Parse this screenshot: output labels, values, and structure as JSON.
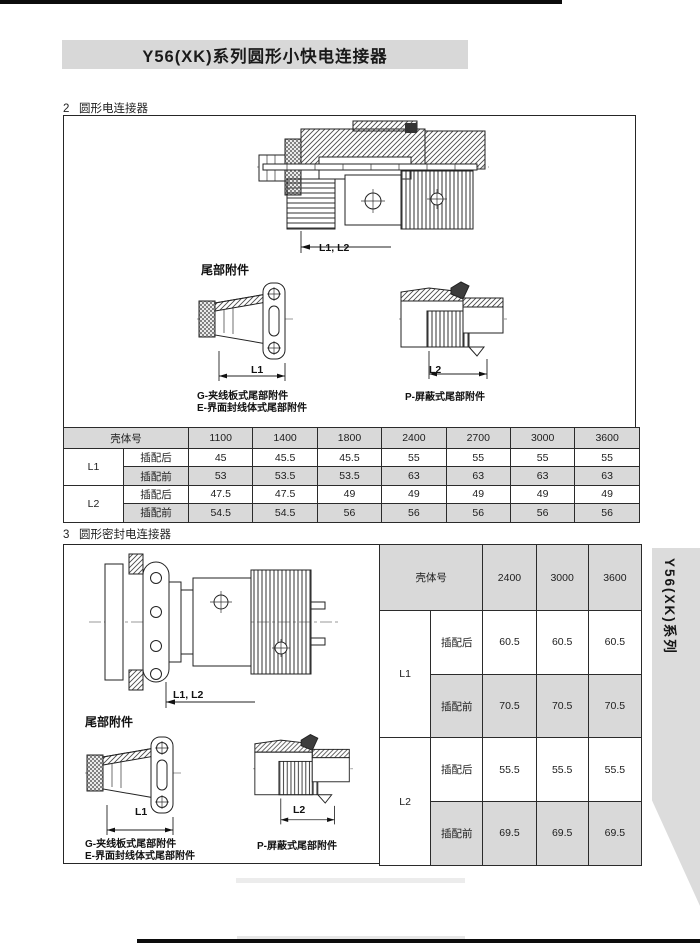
{
  "title_bar": {
    "text": "Y56(XK)系列圆形小快电连接器"
  },
  "side_tab": {
    "text": "Y56(XK)系列"
  },
  "colors": {
    "panel_gray": "#d8d8d8",
    "table_gray": "#d9d9d9",
    "tab_gray": "#dcdcdc",
    "line": "#262626"
  },
  "section2": {
    "heading": "2   圆形电连接器",
    "labels": {
      "dim_l1l2": "L1, L2",
      "tail_title": "尾部附件",
      "dim_l1": "L1",
      "dim_l2": "L2",
      "caption_g": "G-夹线板式尾部附件",
      "caption_e": "E-界面封线体式尾部附件",
      "caption_p": "P-屏蔽式尾部附件"
    },
    "table": {
      "header_label": "壳体号",
      "columns": [
        "1100",
        "1400",
        "1800",
        "2400",
        "2700",
        "3000",
        "3600"
      ],
      "groups": [
        {
          "name": "L1",
          "rows": [
            {
              "label": "插配后",
              "values": [
                "45",
                "45.5",
                "45.5",
                "55",
                "55",
                "55",
                "55"
              ]
            },
            {
              "label": "插配前",
              "values": [
                "53",
                "53.5",
                "53.5",
                "63",
                "63",
                "63",
                "63"
              ]
            }
          ]
        },
        {
          "name": "L2",
          "rows": [
            {
              "label": "插配后",
              "values": [
                "47.5",
                "47.5",
                "49",
                "49",
                "49",
                "49",
                "49"
              ]
            },
            {
              "label": "插配前",
              "values": [
                "54.5",
                "54.5",
                "56",
                "56",
                "56",
                "56",
                "56"
              ]
            }
          ]
        }
      ]
    }
  },
  "section3": {
    "heading": "3   圆形密封电连接器",
    "labels": {
      "dim_l1l2": "L1, L2",
      "tail_title": "尾部附件",
      "dim_l1": "L1",
      "dim_l2": "L2",
      "caption_g": "G-夹线板式尾部附件",
      "caption_e": "E-界面封线体式尾部附件",
      "caption_p": "P-屏蔽式尾部附件"
    },
    "table": {
      "header_label": "壳体号",
      "columns": [
        "2400",
        "3000",
        "3600"
      ],
      "groups": [
        {
          "name": "L1",
          "rows": [
            {
              "label": "插配后",
              "values": [
                "60.5",
                "60.5",
                "60.5"
              ]
            },
            {
              "label": "插配前",
              "values": [
                "70.5",
                "70.5",
                "70.5"
              ]
            }
          ]
        },
        {
          "name": "L2",
          "rows": [
            {
              "label": "插配后",
              "values": [
                "55.5",
                "55.5",
                "55.5"
              ]
            },
            {
              "label": "插配前",
              "values": [
                "69.5",
                "69.5",
                "69.5"
              ]
            }
          ]
        }
      ]
    }
  }
}
